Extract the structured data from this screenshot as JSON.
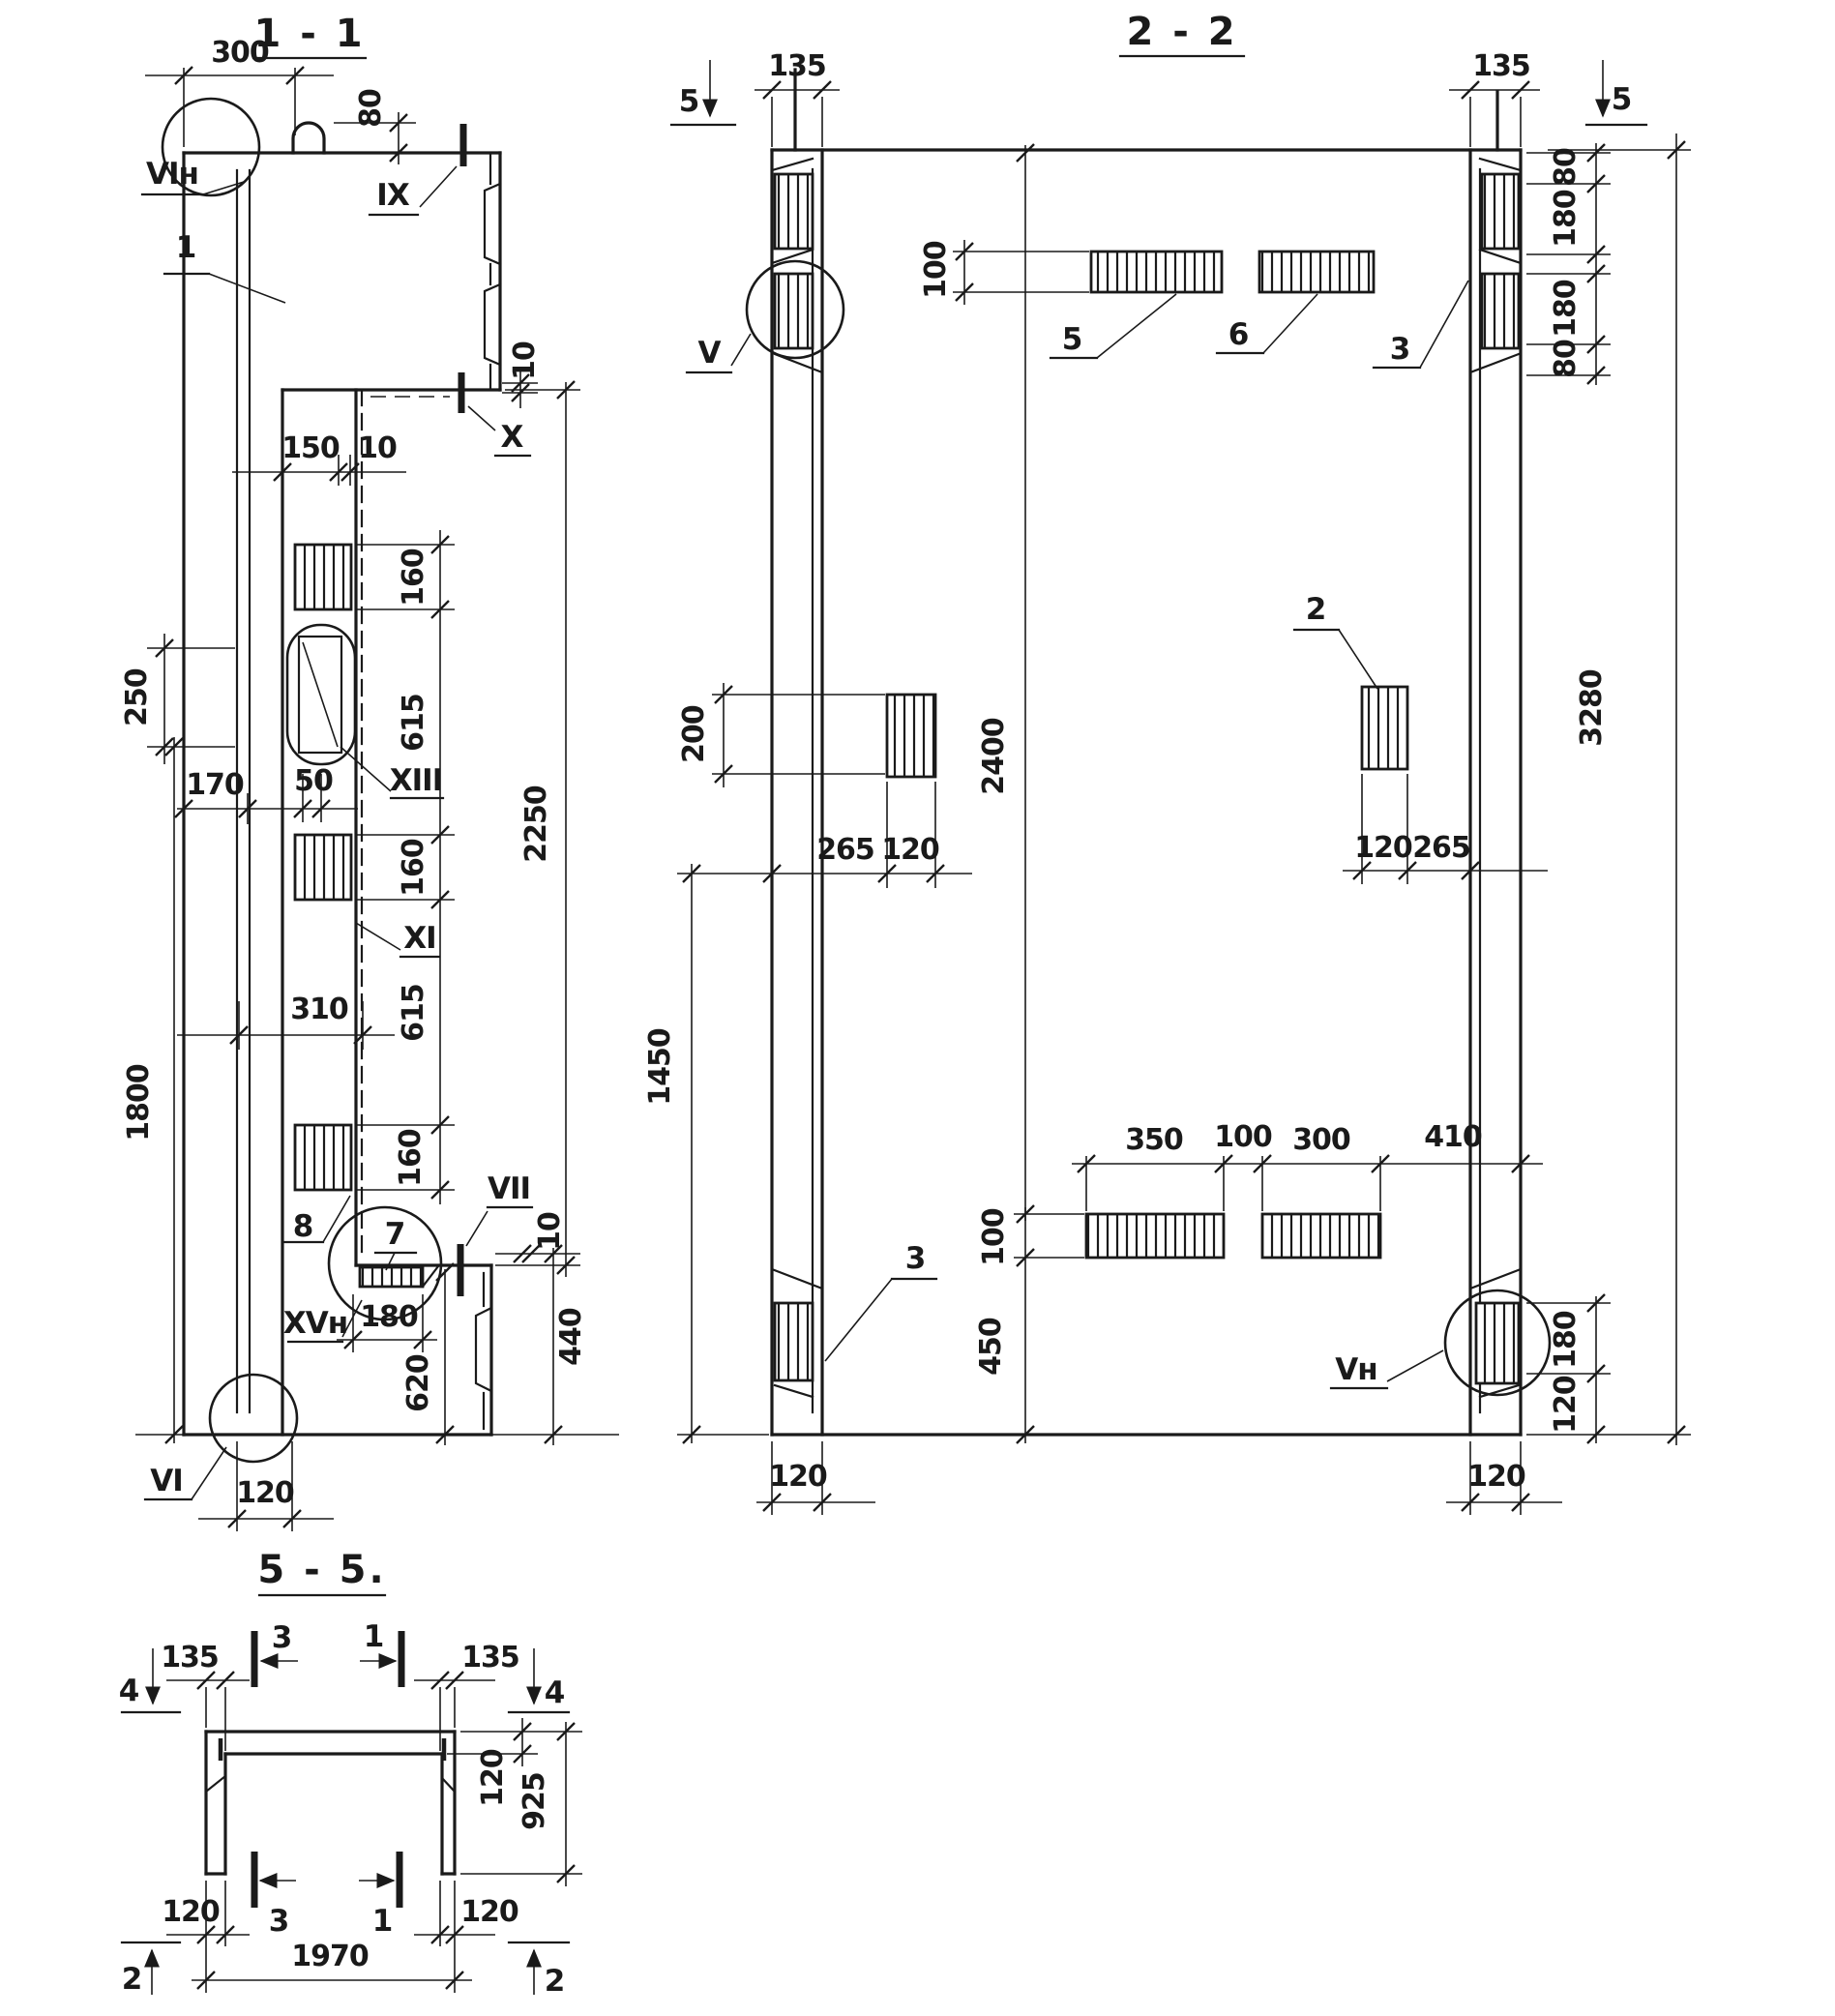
{
  "s11": {
    "title": "1 - 1",
    "labels": {
      "vi_top": "VIн",
      "item1": "1",
      "ix": "IX",
      "x": "X",
      "xiii": "XIII",
      "xi": "XI",
      "item8": "8",
      "item7": "7",
      "vii": "VII",
      "xv": "XVн",
      "vi_bot": "VI"
    },
    "dims": {
      "d300": "300",
      "d80": "80",
      "d10_top": "10",
      "d150": "150",
      "d10_mid": "10",
      "d160_1": "160",
      "d615_1": "615",
      "d160_2": "160",
      "d615_2": "615",
      "d160_3": "160",
      "d250": "250",
      "d170": "170",
      "d50": "50",
      "d310": "310",
      "d1800": "1800",
      "d2250": "2250",
      "d180": "180",
      "d620": "620",
      "d440": "440",
      "d10_bot": "10",
      "d120": "120"
    }
  },
  "s22": {
    "title": "2 - 2",
    "labels": {
      "v": "V",
      "vn": "Vн",
      "item5": "5",
      "item6": "6",
      "item3_top": "3",
      "item3_bot": "3",
      "item2": "2",
      "cut5_l": "5",
      "cut5_r": "5"
    },
    "dims": {
      "d135_l": "135",
      "d135_r": "135",
      "d100_top": "100",
      "d80_1": "80",
      "d180_1": "180",
      "d180_2": "180",
      "d80_2": "80",
      "d3280": "3280",
      "d200": "200",
      "d2400": "2400",
      "d265_l": "265",
      "d120_l": "120",
      "d120_r": "120",
      "d265_r": "265",
      "d1450": "1450",
      "d350": "350",
      "d100_mid": "100",
      "d300": "300",
      "d410": "410",
      "d100_bot": "100",
      "d450": "450",
      "d180_br": "180",
      "d120_br": "120",
      "d120_col_l": "120",
      "d120_col_r": "120"
    }
  },
  "s55": {
    "title": "5 - 5.",
    "labels": {
      "cut4_l": "4",
      "cut4_r": "4",
      "cut3_top": "3",
      "cut1_top": "1",
      "cut3_bot": "3",
      "cut1_bot": "1",
      "cut2_l": "2",
      "cut2_r": "2"
    },
    "dims": {
      "d135_l": "135",
      "d135_r": "135",
      "d120_top": "120",
      "d925": "925",
      "d120_bl": "120",
      "d120_br": "120",
      "d1970": "1970"
    }
  }
}
